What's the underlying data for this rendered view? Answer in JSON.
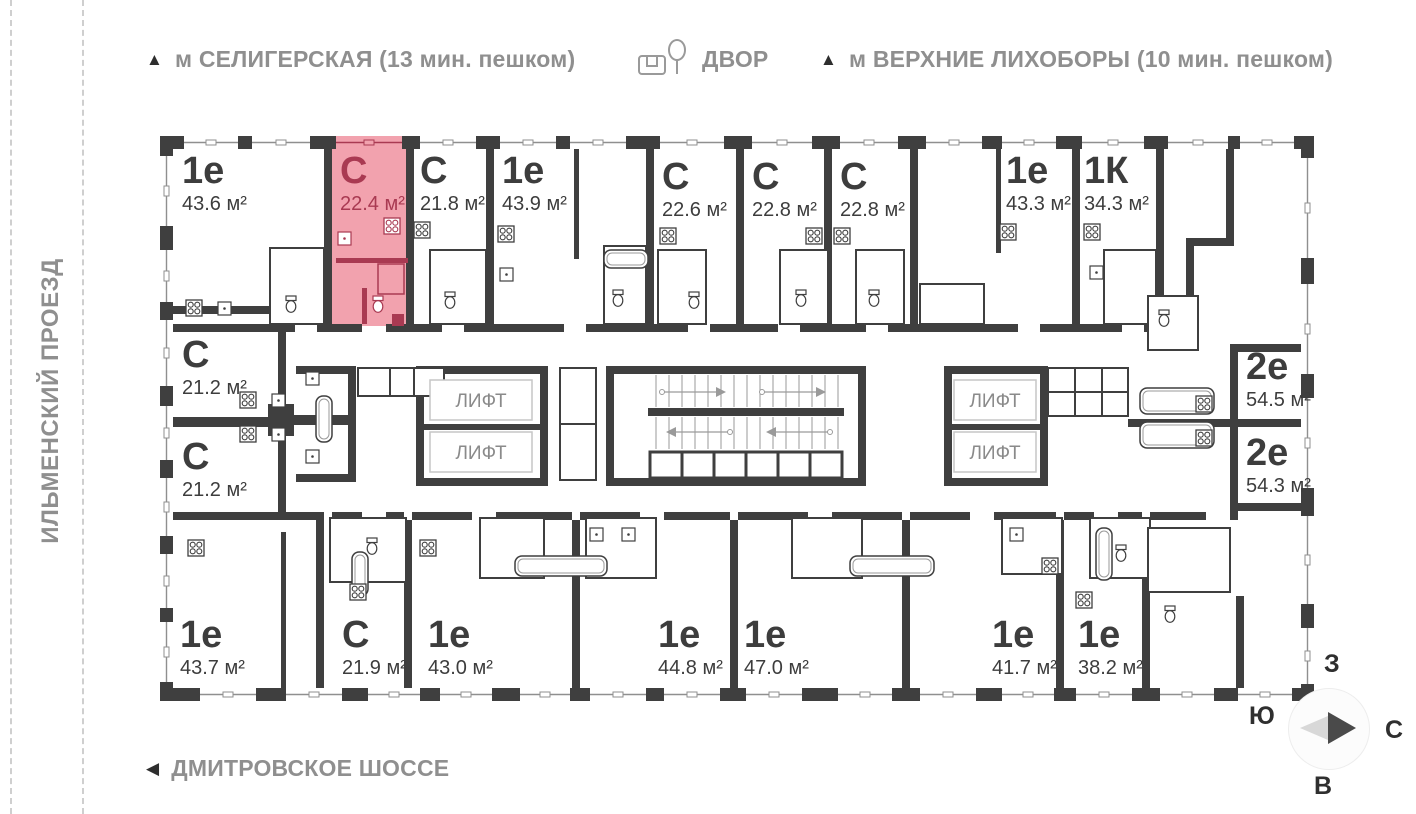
{
  "header": {
    "metro_left": {
      "marker": "▲",
      "label": "м СЕЛИГЕРСКАЯ (13 мин. пешком)"
    },
    "courtyard": {
      "label": "ДВОР"
    },
    "metro_right": {
      "marker": "▲",
      "label": "м ВЕРХНИЕ ЛИХОБОРЫ (10 мин. пешком)"
    }
  },
  "streets": {
    "left_vertical": "ИЛЬМЕНСКИЙ ПРОЕЗД",
    "bottom": {
      "marker": "◀",
      "label": "ДМИТРОВСКОЕ ШОССЕ"
    }
  },
  "compass": {
    "top": "З",
    "left": "Ю",
    "right": "С",
    "bottom": "В"
  },
  "core": {
    "lift_label": "ЛИФТ"
  },
  "colors": {
    "wall": "#3f3f3f",
    "window_line": "#8f8f8f",
    "highlight_fill": "#f2a2ae",
    "highlight_text": "#a93a52",
    "label_text": "#3d3d3d",
    "street_text": "#8f8f8f",
    "lift_text": "#8a8a8a",
    "stair_line": "#9a9a9a"
  },
  "units": [
    {
      "id": "top-1",
      "type": "1е",
      "area": "43.6 м²",
      "highlighted": false
    },
    {
      "id": "top-2",
      "type": "С",
      "area": "22.4 м²",
      "highlighted": true
    },
    {
      "id": "top-3",
      "type": "С",
      "area": "21.8 м²",
      "highlighted": false
    },
    {
      "id": "top-4",
      "type": "1е",
      "area": "43.9 м²",
      "highlighted": false
    },
    {
      "id": "top-5",
      "type": "С",
      "area": "22.6 м²",
      "highlighted": false
    },
    {
      "id": "top-6",
      "type": "С",
      "area": "22.8 м²",
      "highlighted": false
    },
    {
      "id": "top-7",
      "type": "С",
      "area": "22.8 м²",
      "highlighted": false
    },
    {
      "id": "top-8",
      "type": "1е",
      "area": "43.3 м²",
      "highlighted": false
    },
    {
      "id": "top-9",
      "type": "1К",
      "area": "34.3 м²",
      "highlighted": false
    },
    {
      "id": "left-1",
      "type": "С",
      "area": "21.2 м²",
      "highlighted": false
    },
    {
      "id": "left-2",
      "type": "С",
      "area": "21.2 м²",
      "highlighted": false
    },
    {
      "id": "right-1",
      "type": "2е",
      "area": "54.5 м²",
      "highlighted": false
    },
    {
      "id": "right-2",
      "type": "2е",
      "area": "54.3 м²",
      "highlighted": false
    },
    {
      "id": "bottom-1",
      "type": "1е",
      "area": "43.7 м²",
      "highlighted": false
    },
    {
      "id": "bottom-2",
      "type": "С",
      "area": "21.9 м²",
      "highlighted": false
    },
    {
      "id": "bottom-3",
      "type": "1е",
      "area": "43.0 м²",
      "highlighted": false
    },
    {
      "id": "bottom-4",
      "type": "1е",
      "area": "44.8 м²",
      "highlighted": false
    },
    {
      "id": "bottom-5",
      "type": "1е",
      "area": "47.0 м²",
      "highlighted": false
    },
    {
      "id": "bottom-6",
      "type": "1е",
      "area": "41.7 м²",
      "highlighted": false
    },
    {
      "id": "bottom-7",
      "type": "1е",
      "area": "38.2 м²",
      "highlighted": false
    }
  ]
}
